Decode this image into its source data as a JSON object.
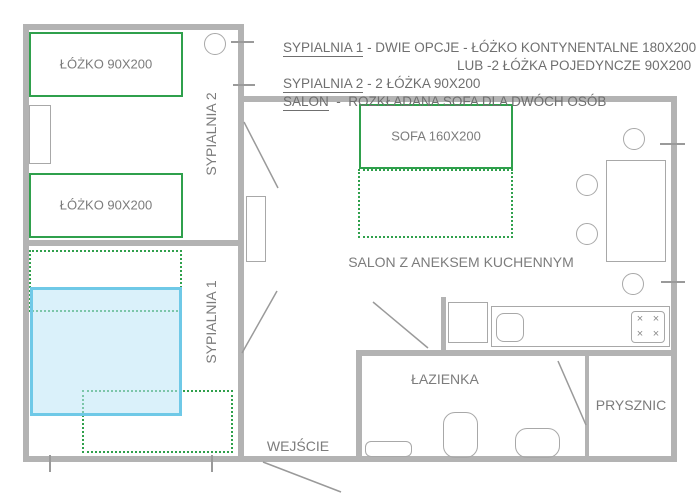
{
  "colors": {
    "accent_green": "#2fa04c",
    "bed_blue_border": "#6fc9e7",
    "bed_blue_fill": "rgba(187,229,246,0.55)",
    "wall_gray": "#b3b3b3",
    "furniture_gray": "#a8a8a8",
    "text_gray": "#7c7c7c"
  },
  "legend": {
    "line1": {
      "term": "SYPIALNIA 1",
      "rest": " - DWIE OPCJE - ŁÓŻKO KONTYNENTALNE 180X200"
    },
    "line2": "LUB -2 ŁÓŻKA POJEDYNCZE 90X200",
    "line3": {
      "term": "SYPIALNIA 2",
      "rest": " - 2 ŁÓŻKA 90X200"
    },
    "line4": {
      "term": "SALON",
      "rest": "  -  ROZKŁADANA SOFA DLA DWÓCH OSÓB"
    }
  },
  "rooms": {
    "bedroom2": "SYPIALNIA 2",
    "bedroom1": "SYPIALNIA 1",
    "living": "SALON Z ANEKSEM KUCHENNYM",
    "bathroom": "ŁAZIENKA",
    "shower": "PRYSZNIC",
    "entrance": "WEJŚCIE"
  },
  "furniture": {
    "bed_top": "ŁÓŻKO 90X200",
    "bed_bottom": "ŁÓŻKO 90X200",
    "sofa": "SOFA 160X200"
  },
  "icons": {
    "burner": "×"
  }
}
